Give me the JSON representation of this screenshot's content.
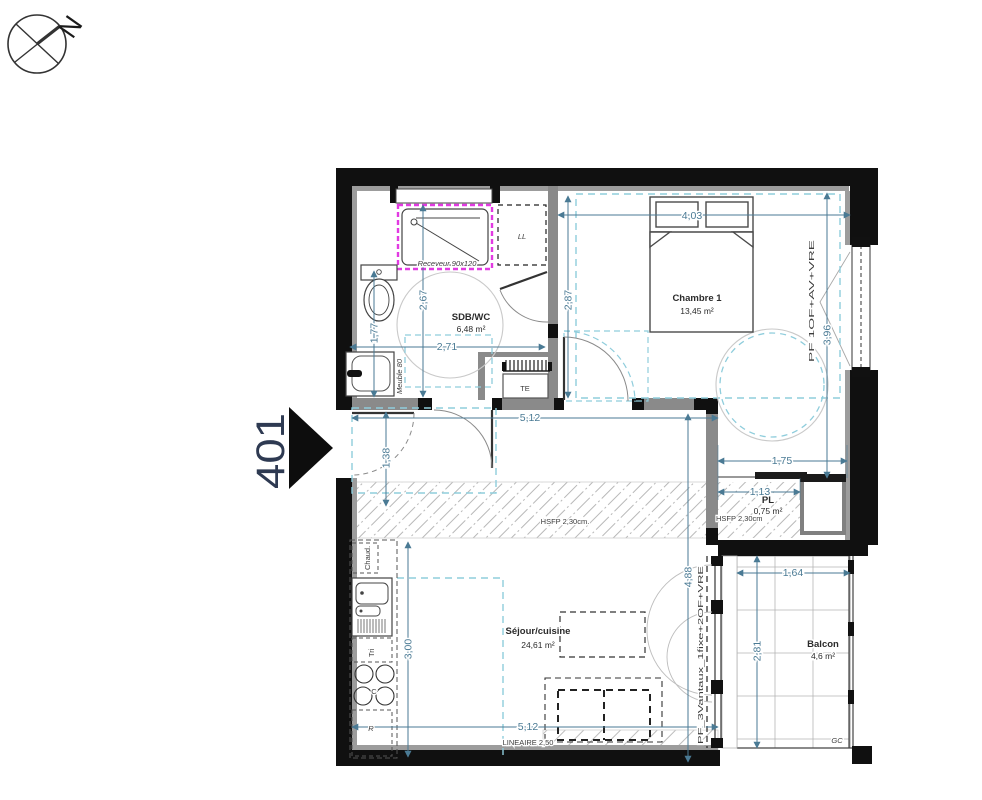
{
  "plan": {
    "unit_number": "401",
    "compass_label": "N"
  },
  "rooms": {
    "sdb": {
      "name": "SDB/WC",
      "area": "6,48 m²"
    },
    "chambre": {
      "name": "Chambre 1",
      "area": "13,45 m²"
    },
    "pl": {
      "name": "PL",
      "area": "0,75 m²"
    },
    "sejour": {
      "name": "Séjour/cuisine",
      "area": "24,61 m²"
    },
    "balcon": {
      "name": "Balcon",
      "area": "4,6 m²"
    }
  },
  "fixtures": {
    "receveur": "Receveur 90x120",
    "lave_linge": "LL",
    "tableau_electrique": "TE",
    "meuble_vasque": "Meuble 80",
    "chaudiere": "Chaud.",
    "tri": "Tri",
    "cuisson": "C",
    "refrigerateur": "R"
  },
  "annotations": {
    "hsfp_corridor": "HSFP 2,30cm.",
    "hsfp_pl": "HSFP 2,30cm",
    "lineaire": "LINEAIRE 2,50",
    "garde_corps": "GC",
    "window_chambre": "PF 1OF+AV+VRE",
    "window_sejour": "PF_3Vantaux_1fixe+2OF+VRE"
  },
  "dimensions": {
    "chambre_width": "4,03",
    "chambre_depth_left": "2,87",
    "chambre_depth_right": "3,96",
    "sdb_depth": "2,67",
    "sdb_left_depth": "1,77",
    "sdb_width": "2,71",
    "hall_width": "5,12",
    "entry_depth": "1,38",
    "pl_zone_width": "1,75",
    "pl_width": "1,13",
    "sejour_depth": "4,88",
    "kitchen_length": "3,00",
    "sejour_width": "5,12",
    "balcon_width": "1,64",
    "balcon_depth": "2,81"
  }
}
